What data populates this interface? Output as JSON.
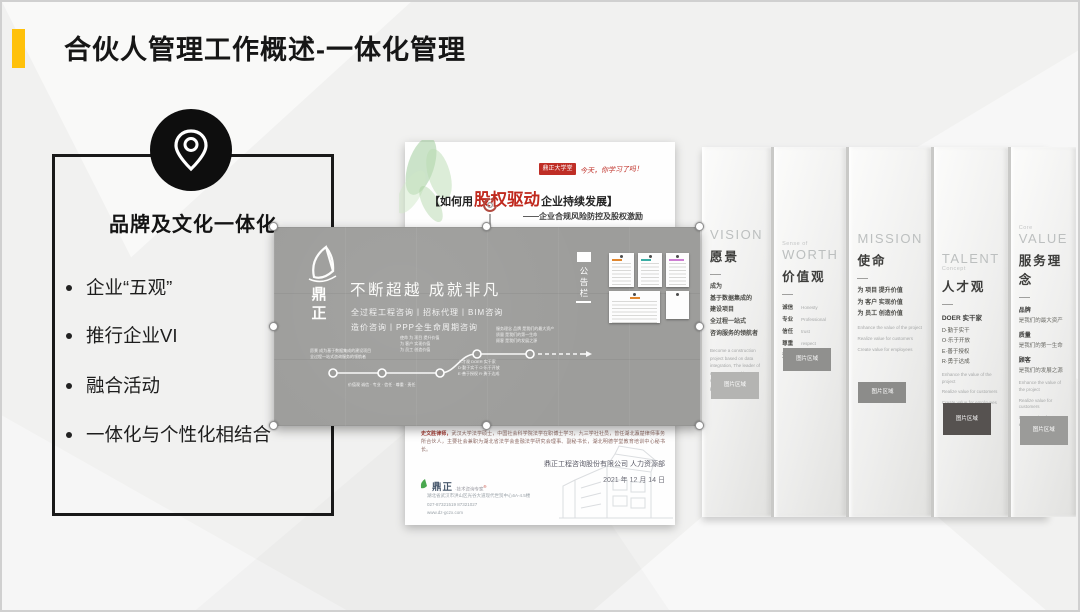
{
  "slide": {
    "title": "合伙人管理工作概述-一体化管理",
    "accent_color": "#ffc10a"
  },
  "left_panel": {
    "heading": "品牌及文化一体化",
    "bullets": [
      "企业“五观”",
      "推行企业VI",
      "融合活动",
      "一体化与个性化相结合"
    ]
  },
  "middle_doc": {
    "badge": "鼎正大学堂",
    "badge_script": "今天，你学习了吗！",
    "title_prefix": "【如何用",
    "title_highlight": "股权驱动",
    "title_suffix": "企业持续发展】",
    "subtitle": "——企业合规风险防控及股权激励",
    "paragraph_lead": "史文胜律师，",
    "paragraph": "武汉大学法学硕士，中国社会科学院法学在职博士学习，九三学社社员，曾任湖北瀛楚律师事务所合伙人，主要社会兼职为湖北省法学会金融法学研究会理事、副秘书长，湖北明德学堂教育培训中心秘书长。",
    "company_line": "鼎正工程咨询股份有限公司 人力资源部",
    "date_line": "2021 年 12 月 14 日",
    "footer_brand": "鼎正",
    "footer_tagline": "·技术咨询专家",
    "footer_reg": "®",
    "footer_address": "湖北省武汉市洪山区光谷大道现代世贸中心6A-4.5楼",
    "footer_phone": "027-87321519  87321027",
    "footer_site": "www.dz-gczx.com"
  },
  "banner": {
    "brand_char_1": "鼎",
    "brand_char_2": "正",
    "headline": "不断超越  成就非凡",
    "services_line1": "全过程工程咨询丨招标代理丨BIM咨询",
    "services_line2": "造价咨询丨PPP全生命周期咨询",
    "board_title": "公告栏",
    "timeline": {
      "vision": "愿景  成为基于数据集成的建设项目\n全过程一站式咨询服务的领航者",
      "values": "价值观  诚信 · 专业 · 信任 · 尊重 · 责任",
      "mission": "使命  为 项目 提升价值\n为 客户 实现价值\n为 员工 创造价值",
      "talent": "人才观  DOER 实干家\nD·勤于实干  O·乐于开放\nE·善于授权  R·勇于达成",
      "service": "服务理念  品牌 是我们的最大资产\n质量 是我们的第一生命\n顾客 是我们的发展之源"
    }
  },
  "right_panel": {
    "image_box_label": "图片区域",
    "columns": [
      {
        "en": "VISION",
        "zh": "愿景",
        "lines": [
          "成为",
          "基于数据集成的",
          "建设项目",
          "全过程一站式",
          "咨询服务的领航者"
        ],
        "para": "Become a construction project based on data integration, The leader of one-stop consulting services throughout the process"
      },
      {
        "eyebrow": "Sense of",
        "en": "WORTH",
        "zh": "价值观",
        "pairs": [
          {
            "zh": "诚信",
            "en": "Honesty"
          },
          {
            "zh": "专业",
            "en": "Professional"
          },
          {
            "zh": "信任",
            "en": "trust"
          },
          {
            "zh": "尊重",
            "en": "respect"
          },
          {
            "zh": "责任",
            "en": "responsibility"
          }
        ]
      },
      {
        "en": "MISSION",
        "zh": "使命",
        "lines": [
          "为 项目 提升价值",
          "为 客户 实现价值",
          "为 员工 创造价值"
        ],
        "para_lines": [
          "Enhance the value of the project",
          "Realize value for customers",
          "Create value for employees"
        ]
      },
      {
        "en": "TALENT",
        "eyebrow_below": "Concept",
        "zh": "人才观",
        "bold_line": "DOER 实干家",
        "lines": [
          "D·勤于实干",
          "O·乐于开放",
          "E·善于授权",
          "R·勇于达成"
        ],
        "para_lines": [
          "Enhance the value of the project",
          "Realize value for customers",
          "Create value for employees"
        ]
      },
      {
        "eyebrow": "Core",
        "en": "VALUE",
        "zh": "服务理念",
        "groups": [
          {
            "label": "品牌",
            "desc": "是我们的最大资产"
          },
          {
            "label": "质量",
            "desc": "是我们的第一生命"
          },
          {
            "label": "顾客",
            "desc": "是我们的发展之源"
          }
        ],
        "para_lines": [
          "Enhance the value of the project",
          "Realize value for customers",
          "Create value for employees"
        ]
      }
    ]
  }
}
